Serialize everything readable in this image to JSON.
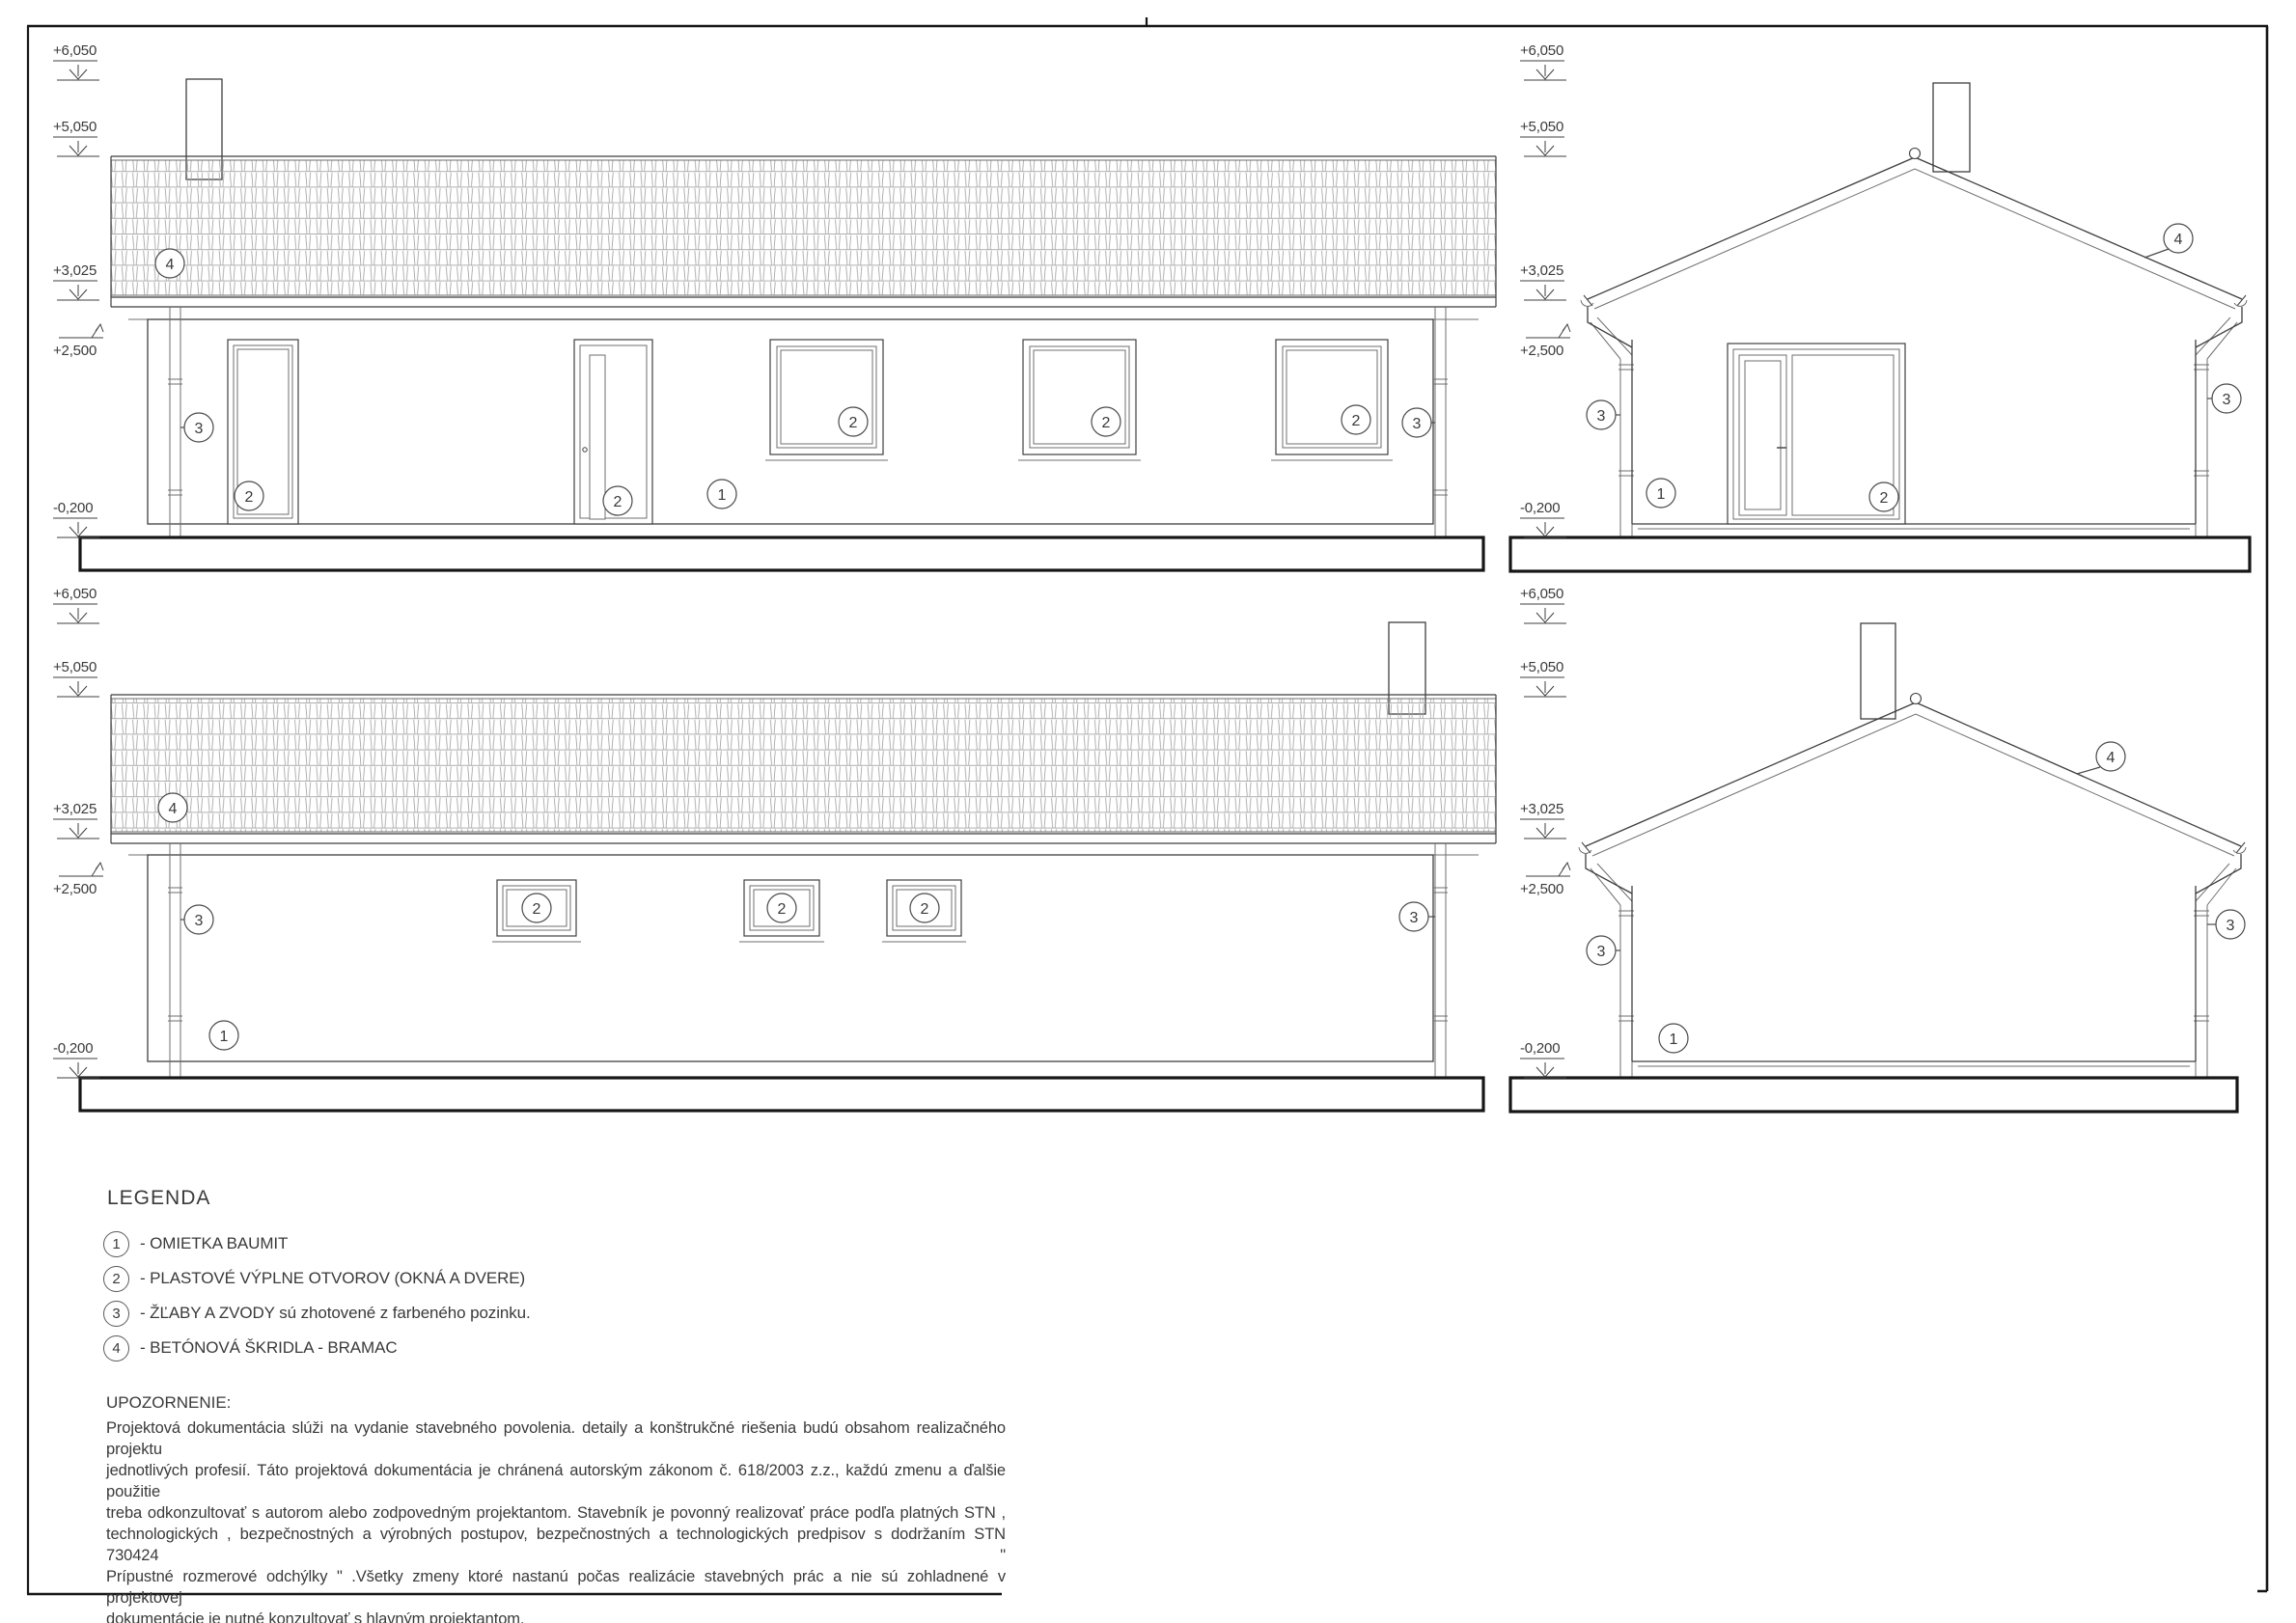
{
  "drawing": {
    "levels": {
      "plus6050": "+6,050",
      "plus5050": "+5,050",
      "plus3025": "+3,025",
      "plus2500": "+2,500",
      "minus0200": "-0,200"
    },
    "callouts": {
      "c1": "1",
      "c2": "2",
      "c3": "3",
      "c4": "4"
    },
    "legend": {
      "title": "LEGENDA",
      "items": [
        {
          "num": "1",
          "label": "- OMIETKA BAUMIT"
        },
        {
          "num": "2",
          "label": "- PLASTOVÉ VÝPLNE OTVOROV (OKNÁ A DVERE)"
        },
        {
          "num": "3",
          "label": "- ŽĽABY A ZVODY sú zhotovené z farbeného pozinku."
        },
        {
          "num": "4",
          "label": "- BETÓNOVÁ ŠKRIDLA - BRAMAC"
        }
      ]
    },
    "note": {
      "title": "UPOZORNENIE:",
      "lines": [
        "Projektová dokumentácia slúži na vydanie stavebného povolenia. detaily a konštrukčné riešenia budú obsahom realizačného projektu",
        "jednotlivých profesií. Táto projektová dokumentácia je chránená autorským zákonom č. 618/2003 z.z., každú zmenu a ďalšie použitie",
        "treba odkonzultovať s autorom alebo zodpovedným projektantom. Stavebník je povonný realizovať práce podľa platných STN ,",
        "technologických , bezpečnostných a výrobných postupov, bezpečnostných a technologických predpisov s dodržaním STN 730424 \"",
        "Prípustné rozmerové odchýlky \" .Všetky zmeny ktoré nastanú počas realizácie stavebných prác a nie sú zohladnené v projektovej",
        "dokumentácie je nutné konzultovať s hlavným projektantom."
      ]
    },
    "colors": {
      "line": "#3f3f3f",
      "thin": "#6f6f6f",
      "tile": "#a3a3a3",
      "thick": "#161616",
      "text": "#3a3a3a"
    }
  }
}
